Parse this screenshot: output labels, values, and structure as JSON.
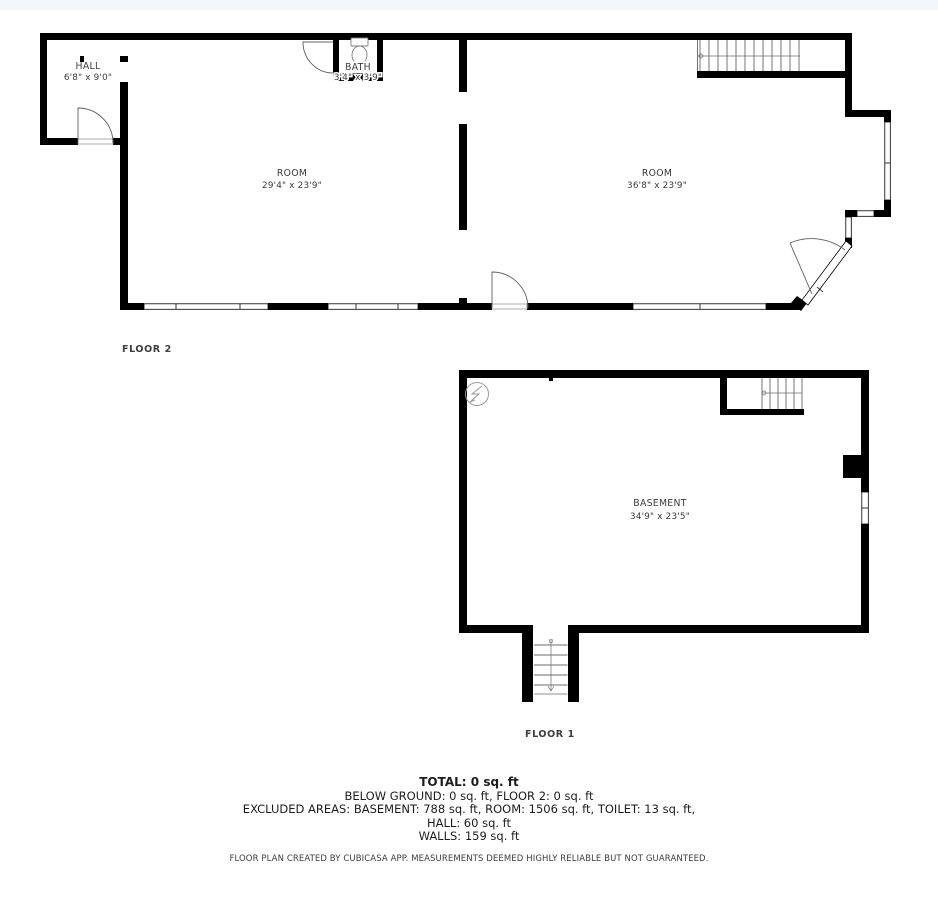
{
  "colors": {
    "wall": "#000000",
    "label": "#3a3a3a",
    "symbol_stroke": "#9a9a9a",
    "top_band": "#f3f6fa",
    "background": "#ffffff"
  },
  "icons": {
    "electrical_panel": "electrical-panel-icon",
    "toilet": "toilet-icon",
    "stairs_up": "stairs-icon"
  },
  "floor2": {
    "caption": "FLOOR 2",
    "hall": {
      "name": "HALL",
      "dims": "6'8\" x 9'0\""
    },
    "bath": {
      "name": "BATH",
      "dims": "3'4\" x 3'9\""
    },
    "room_left": {
      "name": "ROOM",
      "dims": "29'4\" x 23'9\""
    },
    "room_right": {
      "name": "ROOM",
      "dims": "36'8\" x 23'9\""
    }
  },
  "floor1": {
    "caption": "FLOOR 1",
    "basement": {
      "name": "BASEMENT",
      "dims": "34'9\" x 23'5\""
    }
  },
  "summary": {
    "total": "TOTAL: 0 sq. ft",
    "line2": "BELOW GROUND: 0 sq. ft, FLOOR 2: 0 sq. ft",
    "line3": "EXCLUDED AREAS: BASEMENT: 788 sq. ft, ROOM: 1506 sq. ft, TOILET: 13 sq. ft,",
    "line4": "HALL: 60 sq. ft",
    "line5": "WALLS: 159 sq. ft",
    "disclaimer": "FLOOR PLAN CREATED BY CUBICASA APP. MEASUREMENTS DEEMED HIGHLY RELIABLE BUT NOT GUARANTEED."
  }
}
